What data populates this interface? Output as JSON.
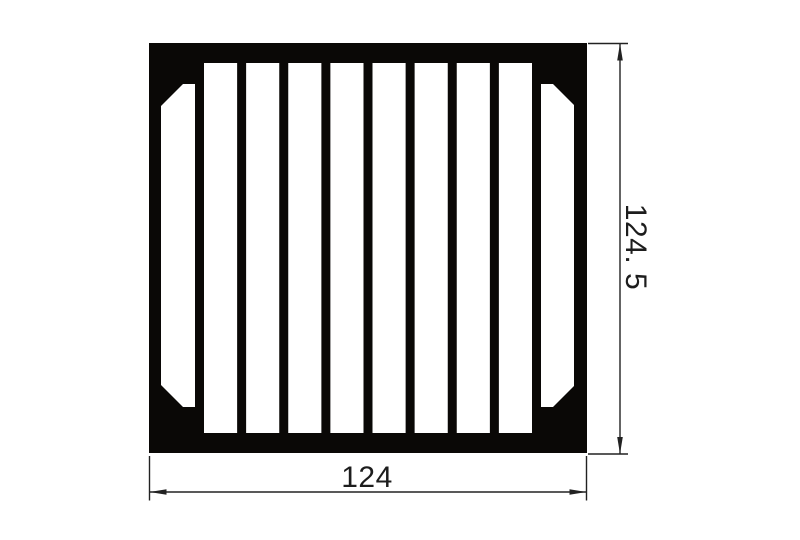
{
  "document": {
    "kind": "technical-drawing",
    "subject": "finned extrusion heatsink profile cross-section"
  },
  "colors": {
    "background": "#ffffff",
    "profile_fill": "#0a0806",
    "slot_fill": "#ffffff",
    "dimension_line": "#222222",
    "dimension_text": "#1d1d1d"
  },
  "profile": {
    "outer": {
      "x": 149,
      "y": 43,
      "width": 438,
      "height": 410
    },
    "fin_slots": {
      "count": 8,
      "first_x": 204,
      "width": 33.125,
      "pitch": 42.125,
      "y": 63,
      "height": 370
    },
    "corner_slot_left_points": "183,84 195,84 195,407 183,407 161,385 161,106",
    "corner_slot_right_points": "541,84 553,84 574,105 574,386 553,407 541,407"
  },
  "dimensions": {
    "width": {
      "label": "124",
      "value": 124
    },
    "height": {
      "label": "124. 5",
      "value": 124.5
    }
  }
}
